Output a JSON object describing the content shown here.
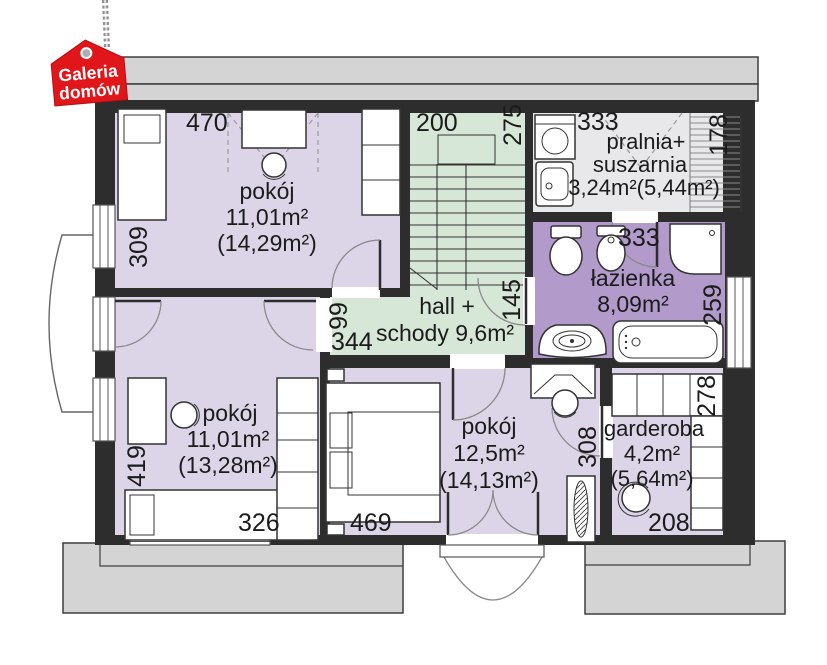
{
  "logo": {
    "line1": "Galeria",
    "line2": "domów"
  },
  "rooms": {
    "room_top_left": {
      "label": "pokój",
      "area": "11,01m²",
      "area_gross": "(14,29m²)",
      "dim_top": "470",
      "dim_left": "309"
    },
    "staircase": {
      "dim_top": "200",
      "dim_right": "275"
    },
    "laundry": {
      "label_line1": "pralnia+",
      "label_line2": "suszarnia",
      "area": "3,24m²(5,44m²)",
      "dim_top": "333",
      "dim_right": "178"
    },
    "bathroom": {
      "label": "łazienka",
      "area": "8,09m²",
      "dim_top": "333",
      "dim_right": "259"
    },
    "hall": {
      "label_line1": "hall +",
      "label_line2": "schody 9,6m²",
      "dim_width": "99",
      "dim_length": "344",
      "dim_door": "145"
    },
    "room_bottom_left": {
      "label": "pokój",
      "area": "11,01m²",
      "area_gross": "(13,28m²)",
      "dim_left": "419",
      "dim_bottom": "326"
    },
    "room_bottom_center": {
      "label": "pokój",
      "area": "12,5m²",
      "area_gross": "(14,13m²)",
      "dim_bottom": "469",
      "dim_right": "308"
    },
    "wardrobe_room": {
      "label": "garderoba",
      "area": "4,2m²",
      "area_gross": "(5,64m²)",
      "dim_top": "278",
      "dim_bottom": "208"
    }
  },
  "colors": {
    "room_purple": "#dcd5e8",
    "bathroom_purple": "#b29aca",
    "hall_green": "#d7e7d7",
    "laundry_grey": "#e8e8ea",
    "wall_black": "#2d2d2d",
    "roof_grey": "#d4d4d4",
    "logo_red": "#e0161b"
  }
}
